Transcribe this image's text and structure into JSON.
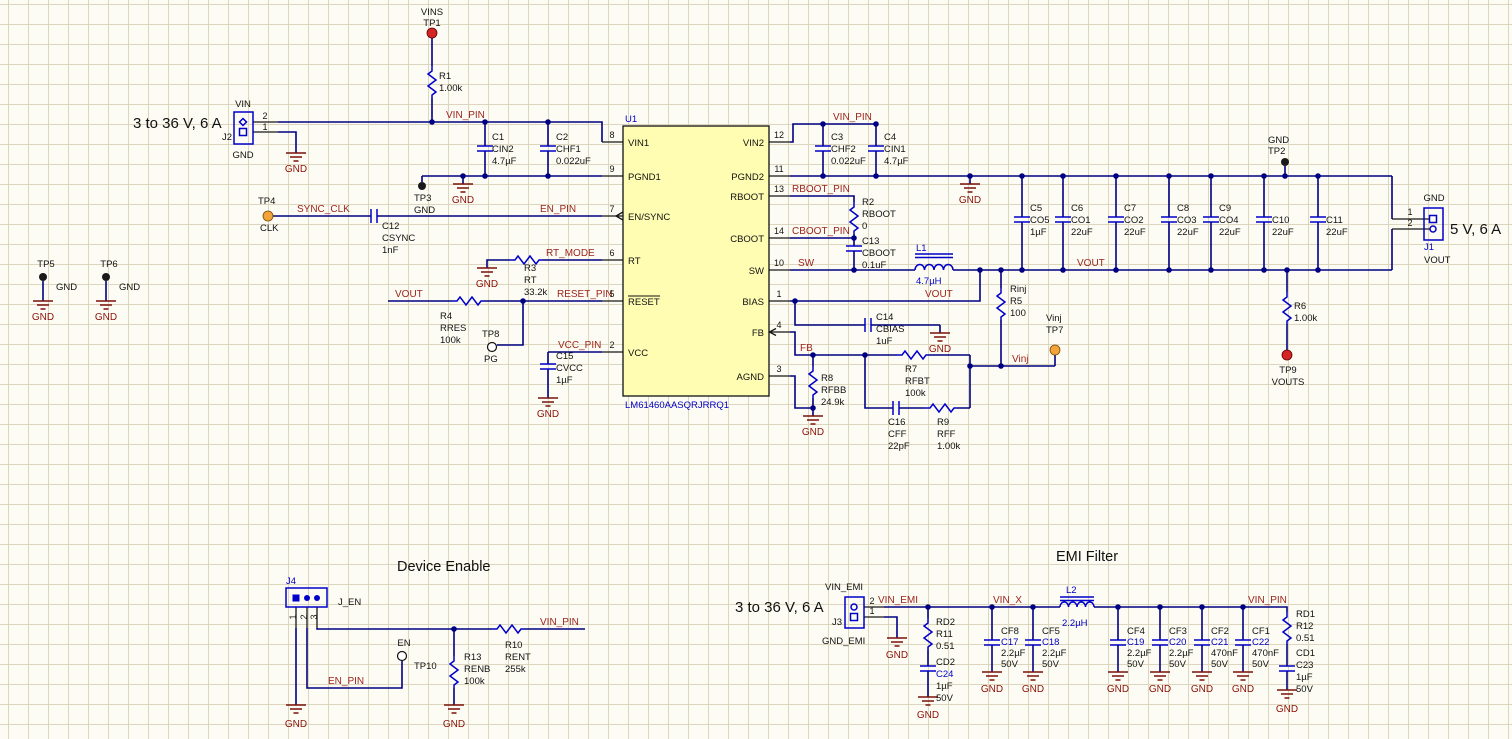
{
  "sheet": {
    "bg": "#FDFCF4",
    "grid": "#DDD6BE",
    "wire_color": "#000082",
    "part_color": "#0000C8",
    "net_color": "#9C241C",
    "gnd_color": "#8B1208",
    "chip_fill": "#FFFDB2",
    "tp_red": "#D42424",
    "tp_orange": "#F2A33B",
    "tp_black": "#1A1A1A"
  },
  "labels": {
    "gnd": "GND",
    "vin_pin": "VIN_PIN",
    "sync_clk": "SYNC_CLK",
    "en_pin": "EN_PIN",
    "rt_mode": "RT_MODE",
    "reset_pin": "RESET_PIN",
    "vcc_pin": "VCC_PIN",
    "vout": "VOUT",
    "rboot_pin": "RBOOT_PIN",
    "cboot_pin": "CBOOT_PIN",
    "sw": "SW",
    "fb": "FB",
    "vinj": "Vinj",
    "vin_emi": "VIN_EMI",
    "vin_x": "VIN_X"
  },
  "main": {
    "input_rating": "3 to 36 V, 6 A",
    "output_rating": "5 V, 6 A",
    "tp1": {
      "name": "VINS",
      "des": "TP1"
    },
    "r1": {
      "des": "R1",
      "value": "1.00k"
    },
    "j2": {
      "port": "VIN",
      "des": "J2",
      "gnd": "GND",
      "pin1": "1",
      "pin2": "2"
    },
    "c1": {
      "des": "C1",
      "name": "CIN2",
      "value": "4.7µF"
    },
    "c2": {
      "des": "C2",
      "name": "CHF1",
      "value": "0.022uF"
    },
    "tp3": {
      "des": "TP3",
      "net": "GND"
    },
    "tp4": {
      "des": "TP4",
      "net": "CLK"
    },
    "c12": {
      "des": "C12",
      "name": "CSYNC",
      "value": "1nF"
    },
    "r3": {
      "des": "R3",
      "name": "RT",
      "value": "33.2k"
    },
    "r4": {
      "des": "R4",
      "name": "RRES",
      "value": "100k"
    },
    "tp8": {
      "des": "TP8",
      "net": "PG"
    },
    "c15": {
      "des": "C15",
      "name": "CVCC",
      "value": "1µF"
    },
    "u1": {
      "des": "U1",
      "part": "LM61460AASQRJRRQ1",
      "left_pins": [
        {
          "num": "8",
          "name": "VIN1"
        },
        {
          "num": "9",
          "name": "PGND1"
        },
        {
          "num": "7",
          "name": "EN/SYNC"
        },
        {
          "num": "6",
          "name": "RT"
        },
        {
          "num": "5",
          "name": "RESET"
        },
        {
          "num": "2",
          "name": "VCC"
        }
      ],
      "right_pins": [
        {
          "num": "12",
          "name": "VIN2"
        },
        {
          "num": "11",
          "name": "PGND2"
        },
        {
          "num": "13",
          "name": "RBOOT"
        },
        {
          "num": "14",
          "name": "CBOOT"
        },
        {
          "num": "10",
          "name": "SW"
        },
        {
          "num": "1",
          "name": "BIAS"
        },
        {
          "num": "4",
          "name": "FB"
        },
        {
          "num": "3",
          "name": "AGND"
        }
      ]
    },
    "c3": {
      "des": "C3",
      "name": "CHF2",
      "value": "0.022uF"
    },
    "c4": {
      "des": "C4",
      "name": "CIN1",
      "value": "4.7µF"
    },
    "r2": {
      "des": "R2",
      "name": "RBOOT",
      "value": "0"
    },
    "c13": {
      "des": "C13",
      "name": "CBOOT",
      "value": "0.1uF"
    },
    "l1": {
      "des": "L1",
      "value": "4.7µH"
    },
    "c14": {
      "des": "C14",
      "name": "CBIAS",
      "value": "1uF"
    },
    "r5": {
      "name": "Rinj",
      "des": "R5",
      "value": "100"
    },
    "tp7": {
      "net": "Vinj",
      "des": "TP7"
    },
    "r7": {
      "des": "R7",
      "name": "RFBT",
      "value": "100k"
    },
    "r8": {
      "des": "R8",
      "name": "RFBB",
      "value": "24.9k"
    },
    "c16": {
      "des": "C16",
      "name": "CFF",
      "value": "22pF"
    },
    "r9": {
      "des": "R9",
      "name": "RFF",
      "value": "1.00k"
    },
    "c5": {
      "des": "C5",
      "name": "CO5",
      "value": "1µF"
    },
    "c6": {
      "des": "C6",
      "name": "CO1",
      "value": "22uF"
    },
    "c7": {
      "des": "C7",
      "name": "CO2",
      "value": "22uF"
    },
    "c8": {
      "des": "C8",
      "name": "CO3",
      "value": "22uF"
    },
    "c9": {
      "des": "C9",
      "name": "CO4",
      "value": "22uF"
    },
    "c10": {
      "des": "C10",
      "value": "22uF"
    },
    "c11": {
      "des": "C11",
      "value": "22uF"
    },
    "tp2": {
      "net": "GND",
      "des": "TP2"
    },
    "r6": {
      "des": "R6",
      "value": "1.00k"
    },
    "tp9": {
      "des": "TP9",
      "net": "VOUTS"
    },
    "j1": {
      "gnd": "GND",
      "des": "J1",
      "port": "VOUT",
      "pin1": "1",
      "pin2": "2"
    },
    "tp5": {
      "des": "TP5",
      "net": "GND"
    },
    "tp6": {
      "des": "TP6",
      "net": "GND"
    }
  },
  "enable": {
    "title": "Device Enable",
    "j4": {
      "des": "J4",
      "name": "J_EN",
      "pin1": "1",
      "pin2": "2",
      "pin3": "3"
    },
    "tp10": {
      "net": "EN",
      "des": "TP10"
    },
    "r13": {
      "des": "R13",
      "name": "RENB",
      "value": "100k"
    },
    "r10": {
      "des": "R10",
      "name": "RENT",
      "value": "255k"
    }
  },
  "emi": {
    "title": "EMI Filter",
    "input_rating": "3 to 36 V, 6 A",
    "j3": {
      "port": "VIN_EMI",
      "des": "J3",
      "gnd_port": "GND_EMI",
      "pin1": "1",
      "pin2": "2"
    },
    "r11": {
      "alt": "RD2",
      "des": "R11",
      "value": "0.51"
    },
    "c24": {
      "alt": "CD2",
      "des": "C24",
      "value": "1µF",
      "volt": "50V"
    },
    "c17": {
      "alt": "CF8",
      "des": "C17",
      "value": "2.2µF",
      "volt": "50V"
    },
    "c18": {
      "alt": "CF5",
      "des": "C18",
      "value": "2.2µF",
      "volt": "50V"
    },
    "l2": {
      "des": "L2",
      "value": "2.2µH"
    },
    "c19": {
      "alt": "CF4",
      "des": "C19",
      "value": "2.2µF",
      "volt": "50V"
    },
    "c20": {
      "alt": "CF3",
      "des": "C20",
      "value": "2.2µF",
      "volt": "50V"
    },
    "c21": {
      "alt": "CF2",
      "des": "C21",
      "value": "470nF",
      "volt": "50V"
    },
    "c22": {
      "alt": "CF1",
      "des": "C22",
      "value": "470nF",
      "volt": "50V"
    },
    "r12": {
      "alt": "RD1",
      "des": "R12",
      "value": "0.51"
    },
    "c23": {
      "alt": "CD1",
      "des": "C23",
      "value": "1µF",
      "volt": "50V"
    }
  }
}
